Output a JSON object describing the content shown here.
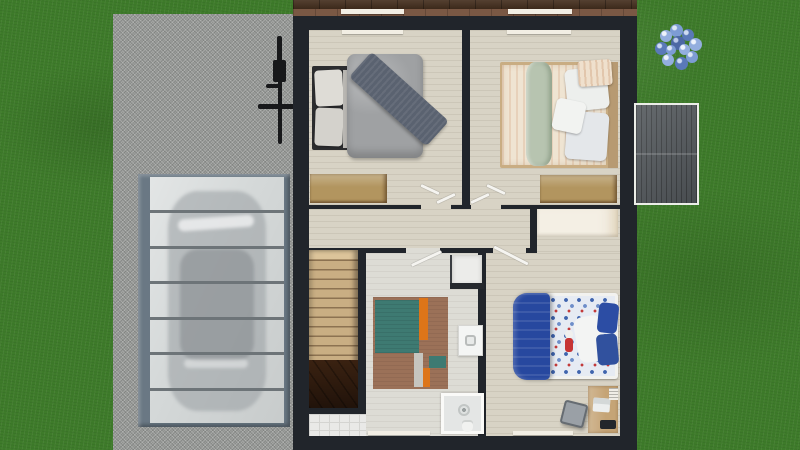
{
  "scene": {
    "type": "3d-floor-plan-top-down-render",
    "view": "upper-floor of a house seen from directly above, surrounded by lawn",
    "exterior_objects": [
      "lawn",
      "driveway",
      "carport-with-glass-slat-roof",
      "car-under-carport",
      "bicycle",
      "hydrangea-bush",
      "shed-roof"
    ],
    "rooms": [
      "bedroom-top-left",
      "bedroom-top-right",
      "hallway-with-closet",
      "staircase",
      "bathroom-laundry-with-rug",
      "kids-bedroom-with-desk"
    ],
    "carport": {
      "panel_count": 7,
      "car_visible_through_roof": true
    },
    "doors_shown_open": 4,
    "windows": 4
  },
  "palette": {
    "grass": "#3e7b2a",
    "driveway": "#9b9d9b",
    "house_wall": "#21252b",
    "eave_dark": "#46301f",
    "eave_light": "#7a5844",
    "sill": "#f2eee4",
    "floor_beige": "#d8d3c5",
    "floor_bath": "#dddcd5",
    "tile_white": "#e9e9e7",
    "closet_white": "#f4efe4",
    "wood_dresser": "#b2955f",
    "wood_desk": "#c5a476",
    "stairs_wood": "#c9ae83",
    "stairs_dark": "#6b513a",
    "rug_brown": "#9b7158",
    "rug_teal": "#3e7a72",
    "rug_orange": "#dd7519",
    "rug_gray": "#c6c5bf",
    "bed1_frame": "#2c2d2f",
    "bed1_duvet": "#9fa1a3",
    "bed1_throw": "#5a6270",
    "bed1_pillow": "#dedcd6",
    "bed2_duvet": "#efe4d2",
    "bed2_throw": "#b7c4b0",
    "bed2_pillow": "#edefed",
    "bed2_headboard": "#b79a72",
    "bed3_duvet": "#27489f",
    "bed3_sheet": "#e6ebf3",
    "bed3_pillow_white": "#f3f4f3",
    "bed3_pillow_blue": "#2c4da4",
    "door_white": "#f5f4f0",
    "fixture_white": "#f4f5f4",
    "shower_inner": "#e4e6e5",
    "counter_dark": "#26292e",
    "carport_frame": "#6a7884",
    "carport_panel": "#d4d8d8",
    "carport_bar": "#6d7478",
    "shed": "#54595d",
    "bike": "#17181a",
    "chair": "#9aa0a6",
    "flower_blue": "#6f8fc8",
    "toy_red": "#c63434"
  }
}
